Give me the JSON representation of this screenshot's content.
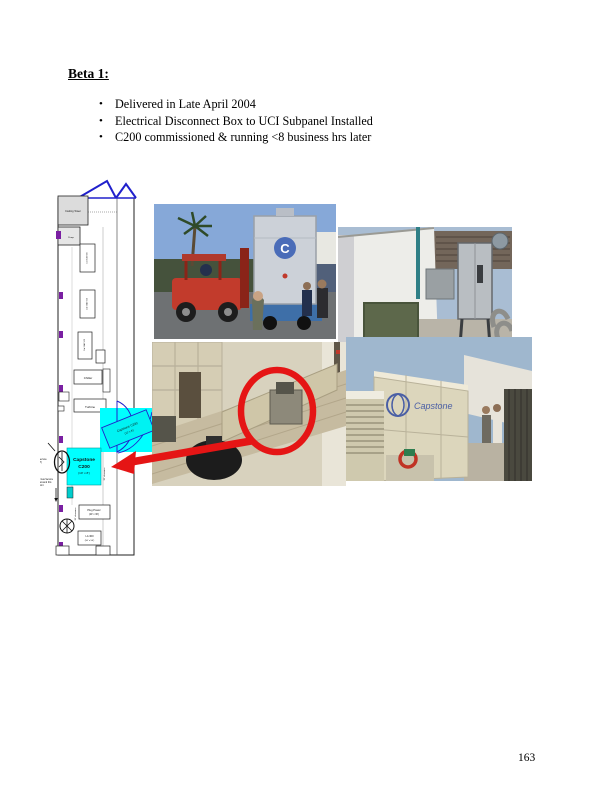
{
  "page": {
    "heading": "Beta 1:",
    "bullet_glyph": "•",
    "bullets": [
      "Delivered in Late April 2004",
      "Electrical Disconnect Box to UCI Subpanel Installed",
      "C200 commissioned & running <8 business hrs later"
    ],
    "page_number": "163"
  },
  "colors": {
    "highlight_cyan": "#00ffff",
    "annotation_red": "#e51515",
    "outline_blue": "#2020cc",
    "marker_purple": "#7a1fa2"
  },
  "diagram": {
    "cooling_tower": "Cooling Tower",
    "pump": "Pump",
    "equipment_boxes": [
      "Cat 5 AJ 500",
      "Cat 5 AD 500",
      "Cat 5 AD 500"
    ],
    "chiller": "Chiller",
    "turbine": "Turbine",
    "capstone_tilted_line1": "Capstone C200",
    "capstone_tilted_line2": "(10' x 8')",
    "capstone_unit": {
      "line1": "Capstone",
      "line2": "C200",
      "line3": "(10' x 8')"
    },
    "service_labels": {
      "vac_line1": "480 VAC Service",
      "vac_line2": "(4w/4P)",
      "gas_line1": "No Natural Gas Service",
      "gas_line2": "plumbed around this",
      "gas_line3": "point"
    },
    "plug_power": {
      "line1": "Plug Power",
      "line2": "(20' x 30')"
    },
    "la300": {
      "line1": "LA 300",
      "line2": "(50' x 50')"
    },
    "clearance": "30' clearance"
  },
  "photos": {
    "capstone_logo_text": "Capstone",
    "crate_logo_letter": "C"
  }
}
